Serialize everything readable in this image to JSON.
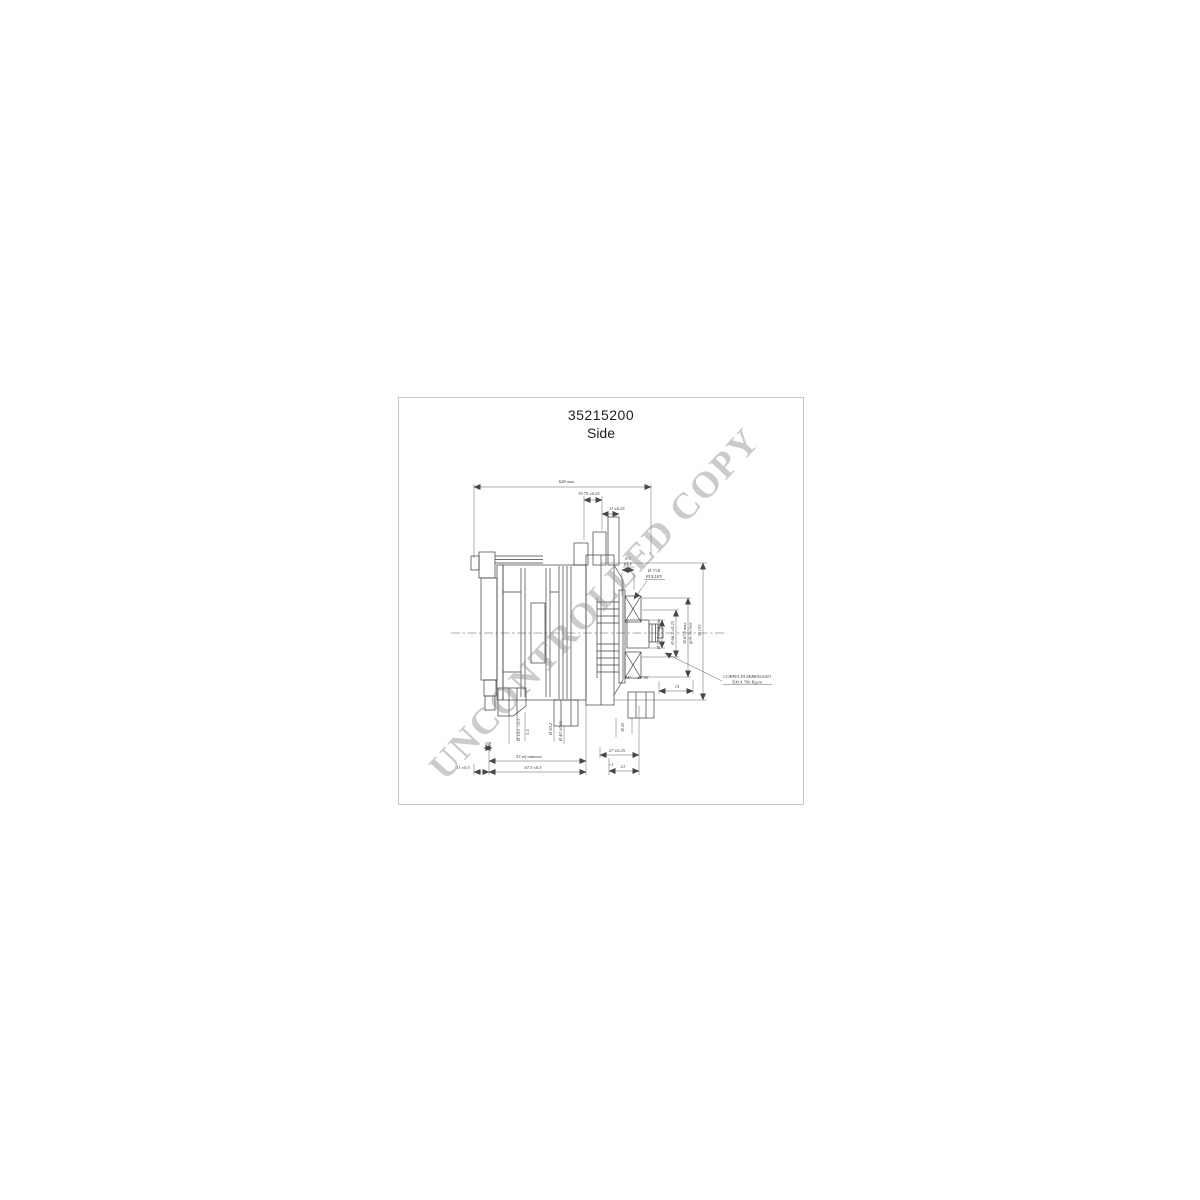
{
  "header": {
    "part_number": "35215200",
    "view_label": "Side"
  },
  "watermark": {
    "text": "UNCONTROLLED COPY"
  },
  "dims": {
    "overall_length": "628 max.",
    "offset_1975": "19.75 ±0.25",
    "offset_11": "11 ±0.25",
    "hub_dia": "Ø 55.7 nominale",
    "groove_root_dia": "Ø 66.7 ±0.25",
    "outer_dia": "Ø 67.9 max",
    "outer_dia_note": "gole incluse",
    "body_dia": "Ø 133",
    "angle_34": "34°",
    "angle_2030": "20°30'",
    "len_15": "15",
    "hole_dia": "Ø 10.5 +0.3",
    "gap_55": "5.5",
    "boss_dia": "Ø 50.2",
    "spigot_dia": "Ø 40 ±0.15",
    "foot_hole_dia": "Ø 25",
    "len_08": "0.8",
    "spline_len": "53 ref annesso",
    "len_11b": "11 ±0.5",
    "len_675": "67.5 ±0.5",
    "len_27": "27 ±0.25",
    "len_21": "21",
    "len_21_tol": "+1"
  },
  "pulley_callout": {
    "width": "8.5",
    "width_ref": "REF",
    "dia": "Ø 73.8",
    "label": "PULLEY"
  },
  "pulley_note": {
    "line1": "COPPIA DI SERRAGGIO",
    "line2": "500 A 700 Kgcm"
  },
  "colors": {
    "ink": "#3e3e3e",
    "frame_border": "#c6c6c6",
    "watermark": "#8e8e8e"
  }
}
